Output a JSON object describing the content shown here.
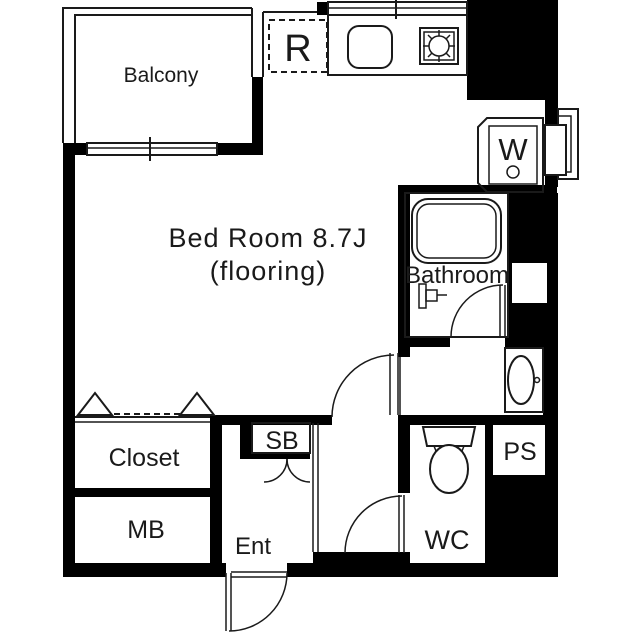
{
  "floorplan": {
    "labels": {
      "balcony": "Balcony",
      "refrigerator": "R",
      "washer": "W",
      "bedroom_line1": "Bed Room 8.7J",
      "bedroom_line2": "(flooring)",
      "bathroom": "Bathroom",
      "closet": "Closet",
      "meter_box": "MB",
      "shoe_box": "SB",
      "entrance": "Ent",
      "toilet_room": "WC",
      "pipe_space": "PS"
    },
    "colors": {
      "wall": "#000000",
      "line": "#1a1a1a",
      "background": "#ffffff"
    }
  }
}
